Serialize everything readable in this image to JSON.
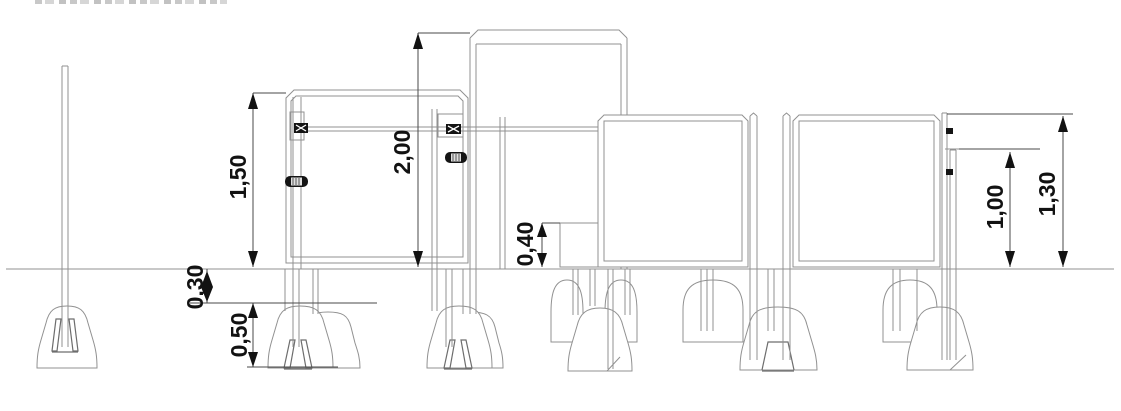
{
  "colors": {
    "background": "#ffffff",
    "linework": "#919191",
    "linework_dark": "#6d6d6d",
    "dimension_lines": "#4a4a4a",
    "annotation": "#121212"
  },
  "dimensions": {
    "sign1_height": "1,50",
    "tall_frame_height": "2,00",
    "ballast_box_height": "0,40",
    "attachment_height": "1,00",
    "panel_height": "1,30",
    "base_offset": "0,30",
    "base_height": "0,50"
  }
}
